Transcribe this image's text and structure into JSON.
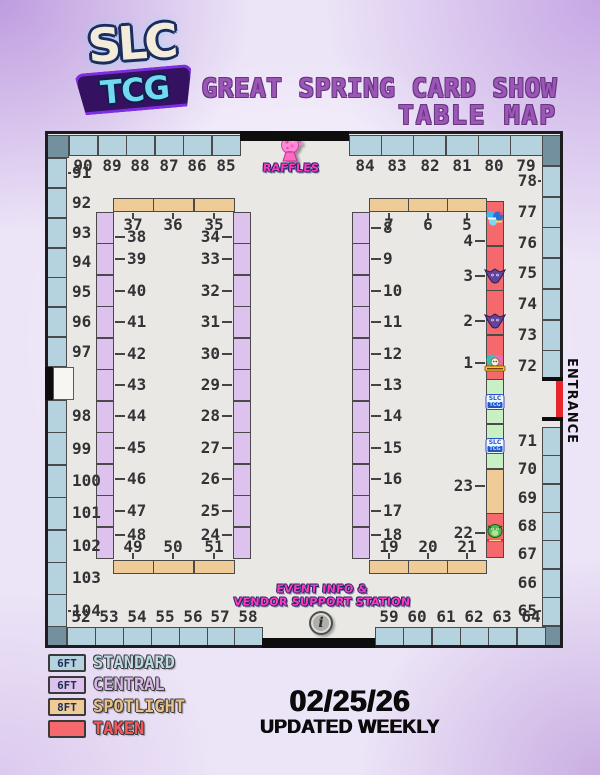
{
  "header": {
    "logo_line1": "SLC",
    "logo_line2": "TCG",
    "title_line1": "GREAT SPRING CARD SHOW",
    "title_line2": "TABLE MAP",
    "title_color": "#9c56b8"
  },
  "map": {
    "raffles_label": "RAFFLES",
    "entrance_label": "ENTRANCE",
    "info_line1": "EVENT INFO &",
    "info_line2": "VENDOR SUPPORT STATION",
    "info_icon_glyph": "i",
    "perimeter": {
      "top_left": [
        "90",
        "89",
        "88",
        "87",
        "86",
        "85"
      ],
      "top_right": [
        "84",
        "83",
        "82",
        "81",
        "80",
        "79"
      ],
      "left_upper": [
        "91",
        "92",
        "93",
        "94",
        "95",
        "96",
        "97"
      ],
      "left_lower": [
        "98",
        "99",
        "100",
        "101",
        "102",
        "103",
        "104"
      ],
      "right_upper": [
        "78",
        "77",
        "76",
        "75",
        "74",
        "73",
        "72"
      ],
      "right_lower": [
        "71",
        "70",
        "69",
        "68",
        "67",
        "66",
        "65"
      ],
      "bottom_left": [
        "52",
        "53",
        "54",
        "55",
        "56",
        "57",
        "58"
      ],
      "bottom_right": [
        "59",
        "60",
        "61",
        "62",
        "63",
        "64"
      ]
    },
    "left_block": {
      "top_row": [
        "37",
        "36",
        "35"
      ],
      "left_col": [
        "38",
        "39",
        "40",
        "41",
        "42",
        "43",
        "44",
        "45",
        "46",
        "47",
        "48"
      ],
      "right_col": [
        "34",
        "33",
        "32",
        "31",
        "30",
        "29",
        "28",
        "27",
        "26",
        "25",
        "24"
      ],
      "bottom_row": [
        "49",
        "50",
        "51"
      ]
    },
    "right_block": {
      "top_row": [
        "7",
        "6",
        "5"
      ],
      "left_col": [
        "8",
        "9",
        "10",
        "11",
        "12",
        "13",
        "14",
        "15",
        "16",
        "17",
        "18"
      ],
      "right_col": [
        {
          "label": "4",
          "type": "taken",
          "sprite": "blue-vendor-logo"
        },
        {
          "label": "3",
          "type": "taken",
          "sprite": "purple-creature"
        },
        {
          "label": "2",
          "type": "taken",
          "sprite": "purple-creature"
        },
        {
          "label": "1",
          "type": "taken",
          "sprite": "rainbow-vendor-logo"
        },
        {
          "label": "",
          "type": "slc",
          "logo_text": "SLC TCG"
        },
        {
          "label": "",
          "type": "slc",
          "logo_text": "SLC TCG"
        },
        {
          "label": "23",
          "type": "spotlight"
        },
        {
          "label": "22",
          "type": "taken",
          "sprite": "green-creature"
        }
      ],
      "bottom_row": [
        "19",
        "20",
        "21"
      ]
    }
  },
  "legend": {
    "items": [
      {
        "size_label": "6FT",
        "name": "STANDARD",
        "swatch_color": "#b4d3de",
        "text_color": "#bddbe5"
      },
      {
        "size_label": "6FT",
        "name": "CENTRAL",
        "swatch_color": "#dcc2ec",
        "text_color": "#d8b9ea"
      },
      {
        "size_label": "8FT",
        "name": "SPOTLIGHT",
        "swatch_color": "#eecb97",
        "text_color": "#eac287"
      },
      {
        "size_label": "",
        "name": "TAKEN",
        "swatch_color": "#f5686c",
        "text_color": "#f5575c"
      }
    ]
  },
  "footer": {
    "date": "02/25/26",
    "note": "UPDATED WEEKLY"
  },
  "colors": {
    "standard": "#b4d3de",
    "central": "#dcc2ec",
    "spotlight": "#eecb97",
    "taken": "#f5686c",
    "slc_table": "#c9efc5",
    "corner": "#73909e",
    "floor": "#eae8e4",
    "wall": "#1d1d1f",
    "entrance_red": "#e8252a",
    "pink": "#ff38c0"
  }
}
